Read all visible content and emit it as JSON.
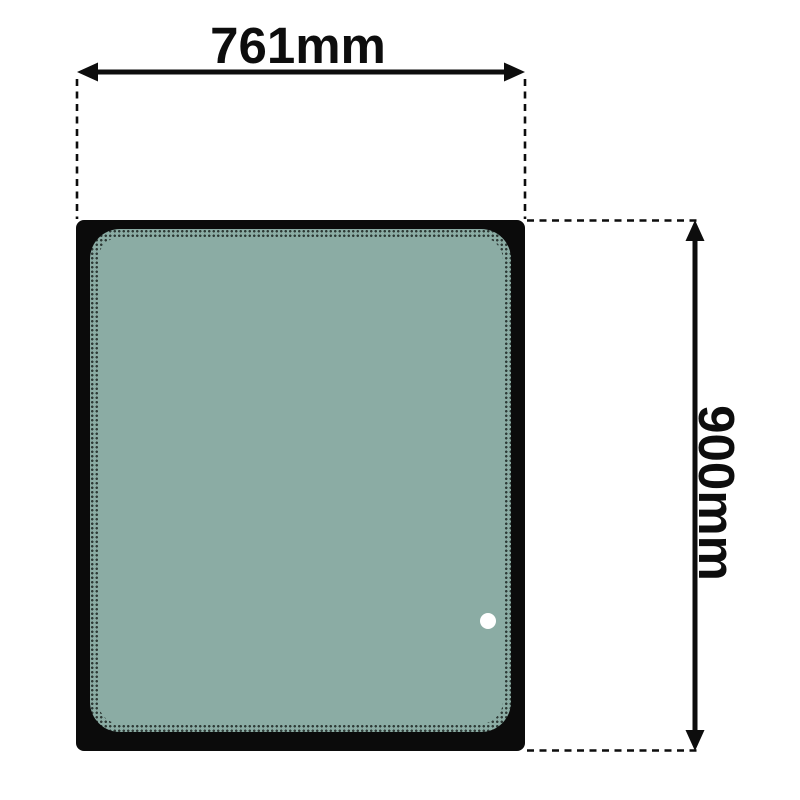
{
  "diagram": {
    "dimensions": {
      "width": {
        "label": "761mm"
      },
      "height": {
        "label": "900mm"
      }
    },
    "colors": {
      "background": "#ffffff",
      "frame": "#0b0b0b",
      "glass": "#8baca4",
      "frit_dot": "#2e3a36",
      "line": "#0d0d0d",
      "hole": "#ffffff"
    }
  }
}
